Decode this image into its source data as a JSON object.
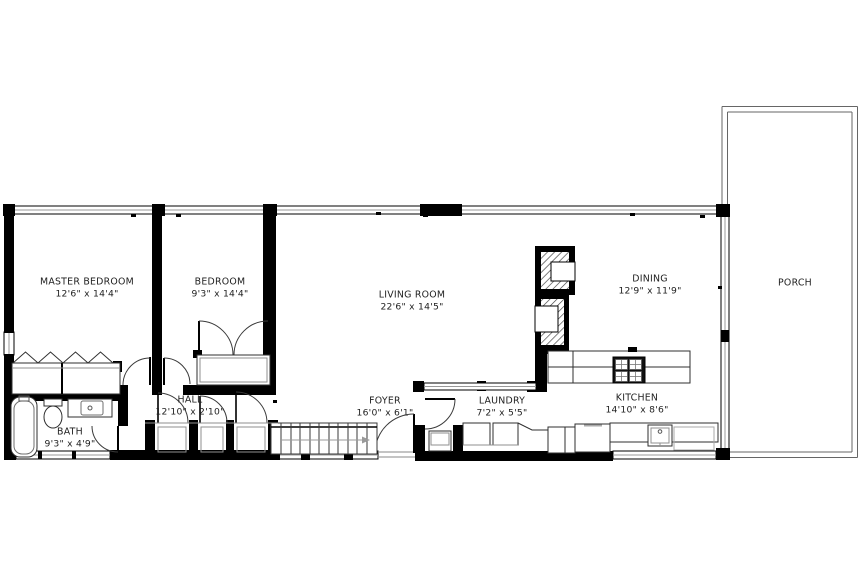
{
  "plan_title": "Single-story house floor plan",
  "colors": {
    "wall": "#000000",
    "line": "#2f2f2f",
    "thin_line": "#8f8f8f",
    "text": "#1e1e1e",
    "background": "#ffffff"
  },
  "rooms": [
    {
      "id": "master-bedroom",
      "name": "MASTER BEDROOM",
      "dims": "12'6\" x 14'4\""
    },
    {
      "id": "bedroom",
      "name": "BEDROOM",
      "dims": "9'3\" x 14'4\""
    },
    {
      "id": "living-room",
      "name": "LIVING ROOM",
      "dims": "22'6\" x 14'5\""
    },
    {
      "id": "dining",
      "name": "DINING",
      "dims": "12'9\" x 11'9\""
    },
    {
      "id": "porch",
      "name": "PORCH",
      "dims": ""
    },
    {
      "id": "bath",
      "name": "BATH",
      "dims": "9'3\" x 4'9\""
    },
    {
      "id": "hall",
      "name": "HALL",
      "dims": "12'10\" x 2'10\""
    },
    {
      "id": "foyer",
      "name": "FOYER",
      "dims": "16'0\" x 6'1\""
    },
    {
      "id": "laundry",
      "name": "LAUNDRY",
      "dims": "7'2\" x 5'5\""
    },
    {
      "id": "kitchen",
      "name": "KITCHEN",
      "dims": "14'10\" x 8'6\""
    }
  ]
}
